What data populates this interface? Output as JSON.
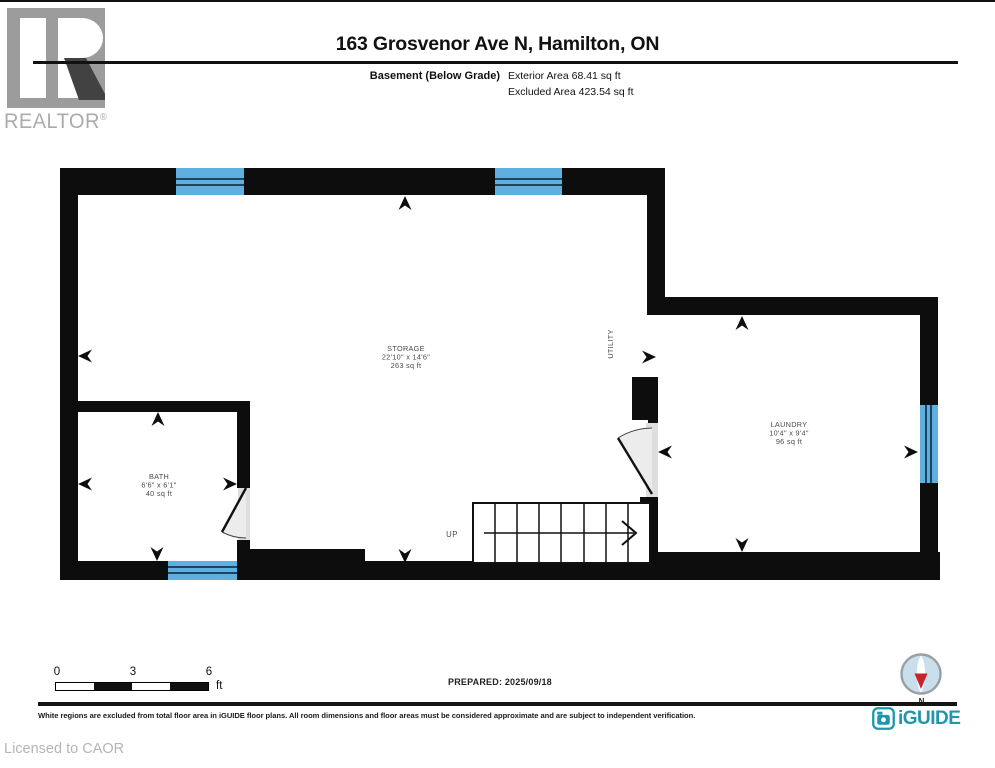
{
  "header": {
    "realtor_brand": "REALTOR",
    "registered_mark": "®",
    "title": "163 Grosvenor Ave N, Hamilton, ON",
    "floor_label": "Basement (Below Grade)",
    "exterior_area": "Exterior Area 68.41 sq ft",
    "excluded_area": "Excluded Area 423.54 sq ft"
  },
  "floorplan": {
    "rooms": [
      {
        "name": "STORAGE",
        "dimensions": "22'10\" x 14'6\"",
        "area": "263 sq ft"
      },
      {
        "name": "BATH",
        "dimensions": "6'6\" x 6'1\"",
        "area": "40 sq ft"
      },
      {
        "name": "LAUNDRY",
        "dimensions": "10'4\" x 9'4\"",
        "area": "96 sq ft"
      }
    ],
    "utility_label": "UTILITY",
    "stairs_label": "UP"
  },
  "scale_bar": {
    "ticks": [
      "0",
      "3",
      "6"
    ],
    "unit": "ft"
  },
  "prepared_label": "PREPARED: 2025/09/18",
  "compass": {
    "north_label": "N"
  },
  "branding": {
    "iguide_label": "iGUIDE"
  },
  "footer": {
    "disclaimer": "White regions are excluded from total floor area in iGUIDE floor plans. All room dimensions and floor areas must be considered approximate and are subject to independent verification.",
    "license": "Licensed to CAOR"
  },
  "colors": {
    "wall": "#0d0d0d",
    "window_fill": "#5fb0e0",
    "window_line": "#1d4560",
    "door_swing": "#ececec",
    "iguide_teal": "#1e96ae",
    "compass_red": "#c9242b",
    "realtor_gray": "#9c9c9c"
  }
}
